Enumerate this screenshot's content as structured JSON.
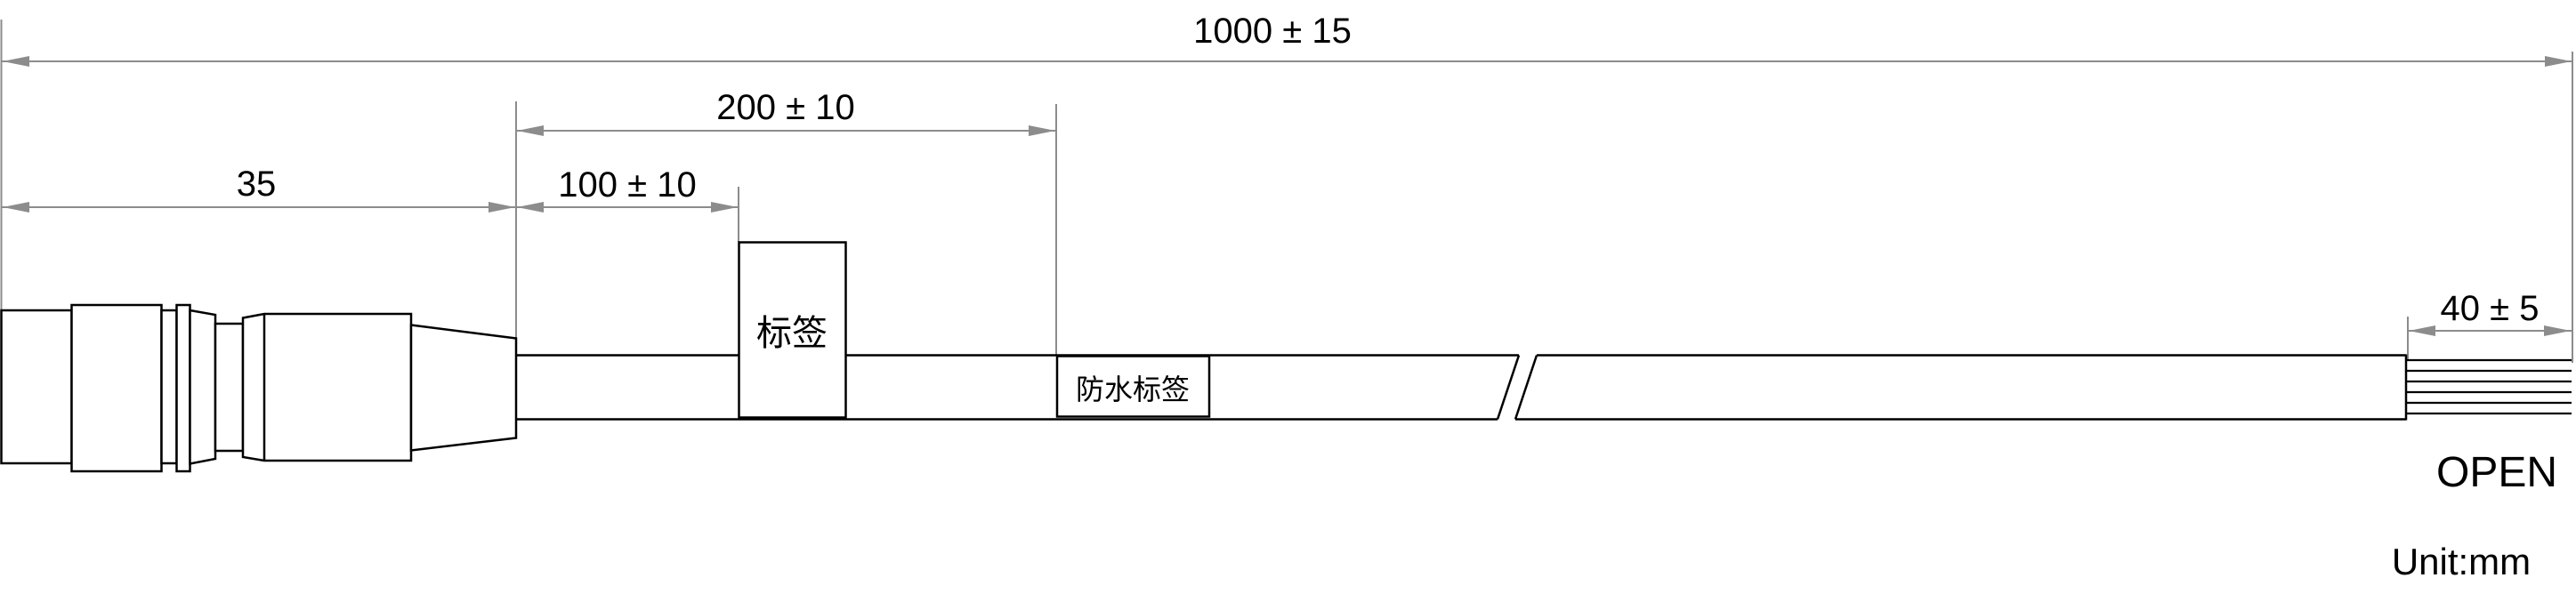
{
  "dimensions": {
    "overall_length": "1000 ± 15",
    "connector_length": "35",
    "label_distance": "100 ± 10",
    "waterproof_label_distance": "200 ± 10",
    "open_wire_length": "40 ± 5"
  },
  "labels": {
    "label_box": "标签",
    "waterproof_label_box": "防水标签",
    "cable_end": "OPEN",
    "unit_note": "Unit:mm"
  },
  "colors": {
    "outline": "#000000",
    "dimension": "#8c8c8c",
    "background": "#ffffff"
  }
}
